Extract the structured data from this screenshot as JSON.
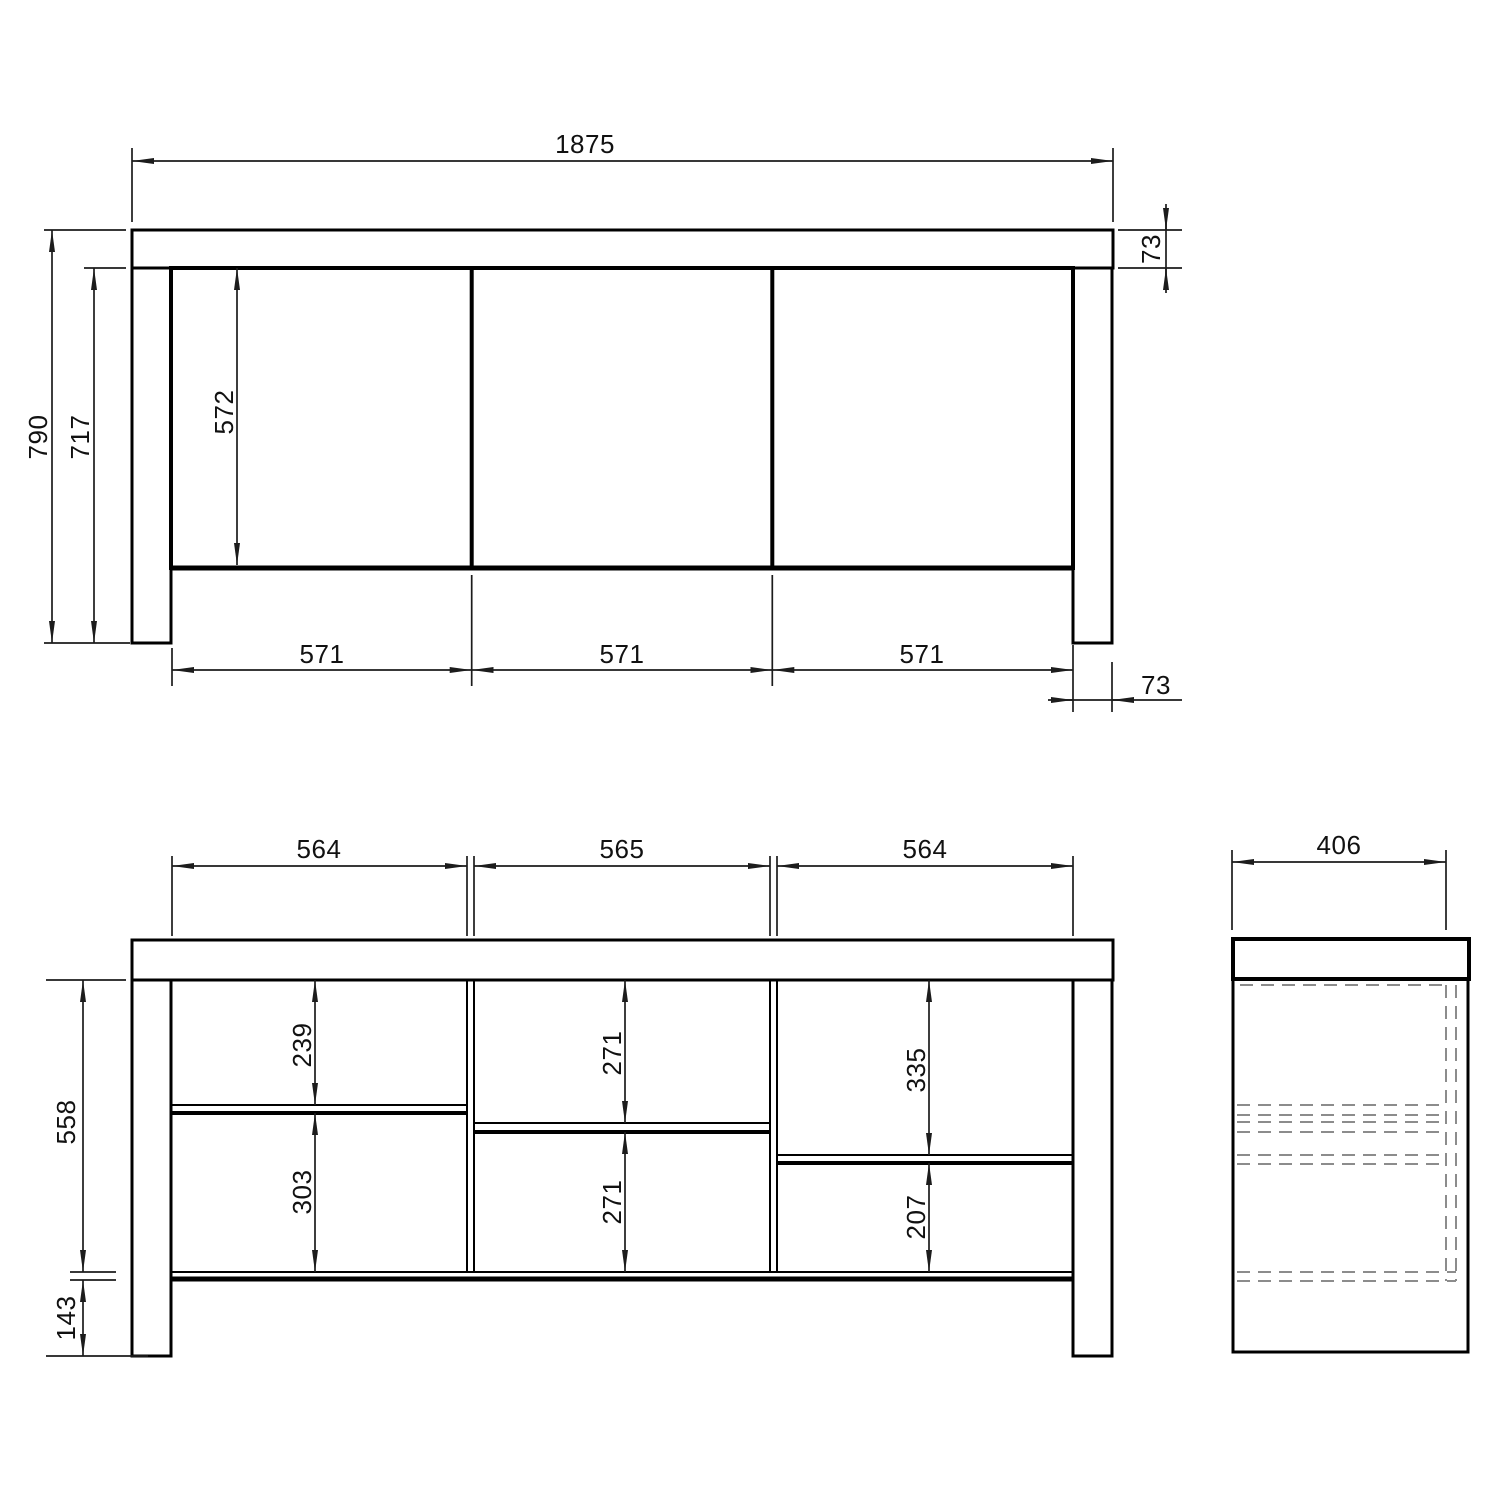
{
  "views": {
    "front": {
      "dims": {
        "overall_width": "1875",
        "top_thickness": "73",
        "overall_height": "790",
        "under_top_height": "717",
        "door_height": "572",
        "door_width_1": "571",
        "door_width_2": "571",
        "door_width_3": "571",
        "leg_width": "73"
      }
    },
    "interior": {
      "dims": {
        "bay_width_1": "564",
        "bay_width_2": "565",
        "bay_width_3": "564",
        "interior_height": "558",
        "base_height": "143",
        "bay1_upper": "239",
        "bay1_lower": "303",
        "bay2_upper": "271",
        "bay2_lower": "271",
        "bay3_upper": "335",
        "bay3_lower": "207"
      }
    },
    "side": {
      "dims": {
        "depth": "406"
      }
    }
  }
}
